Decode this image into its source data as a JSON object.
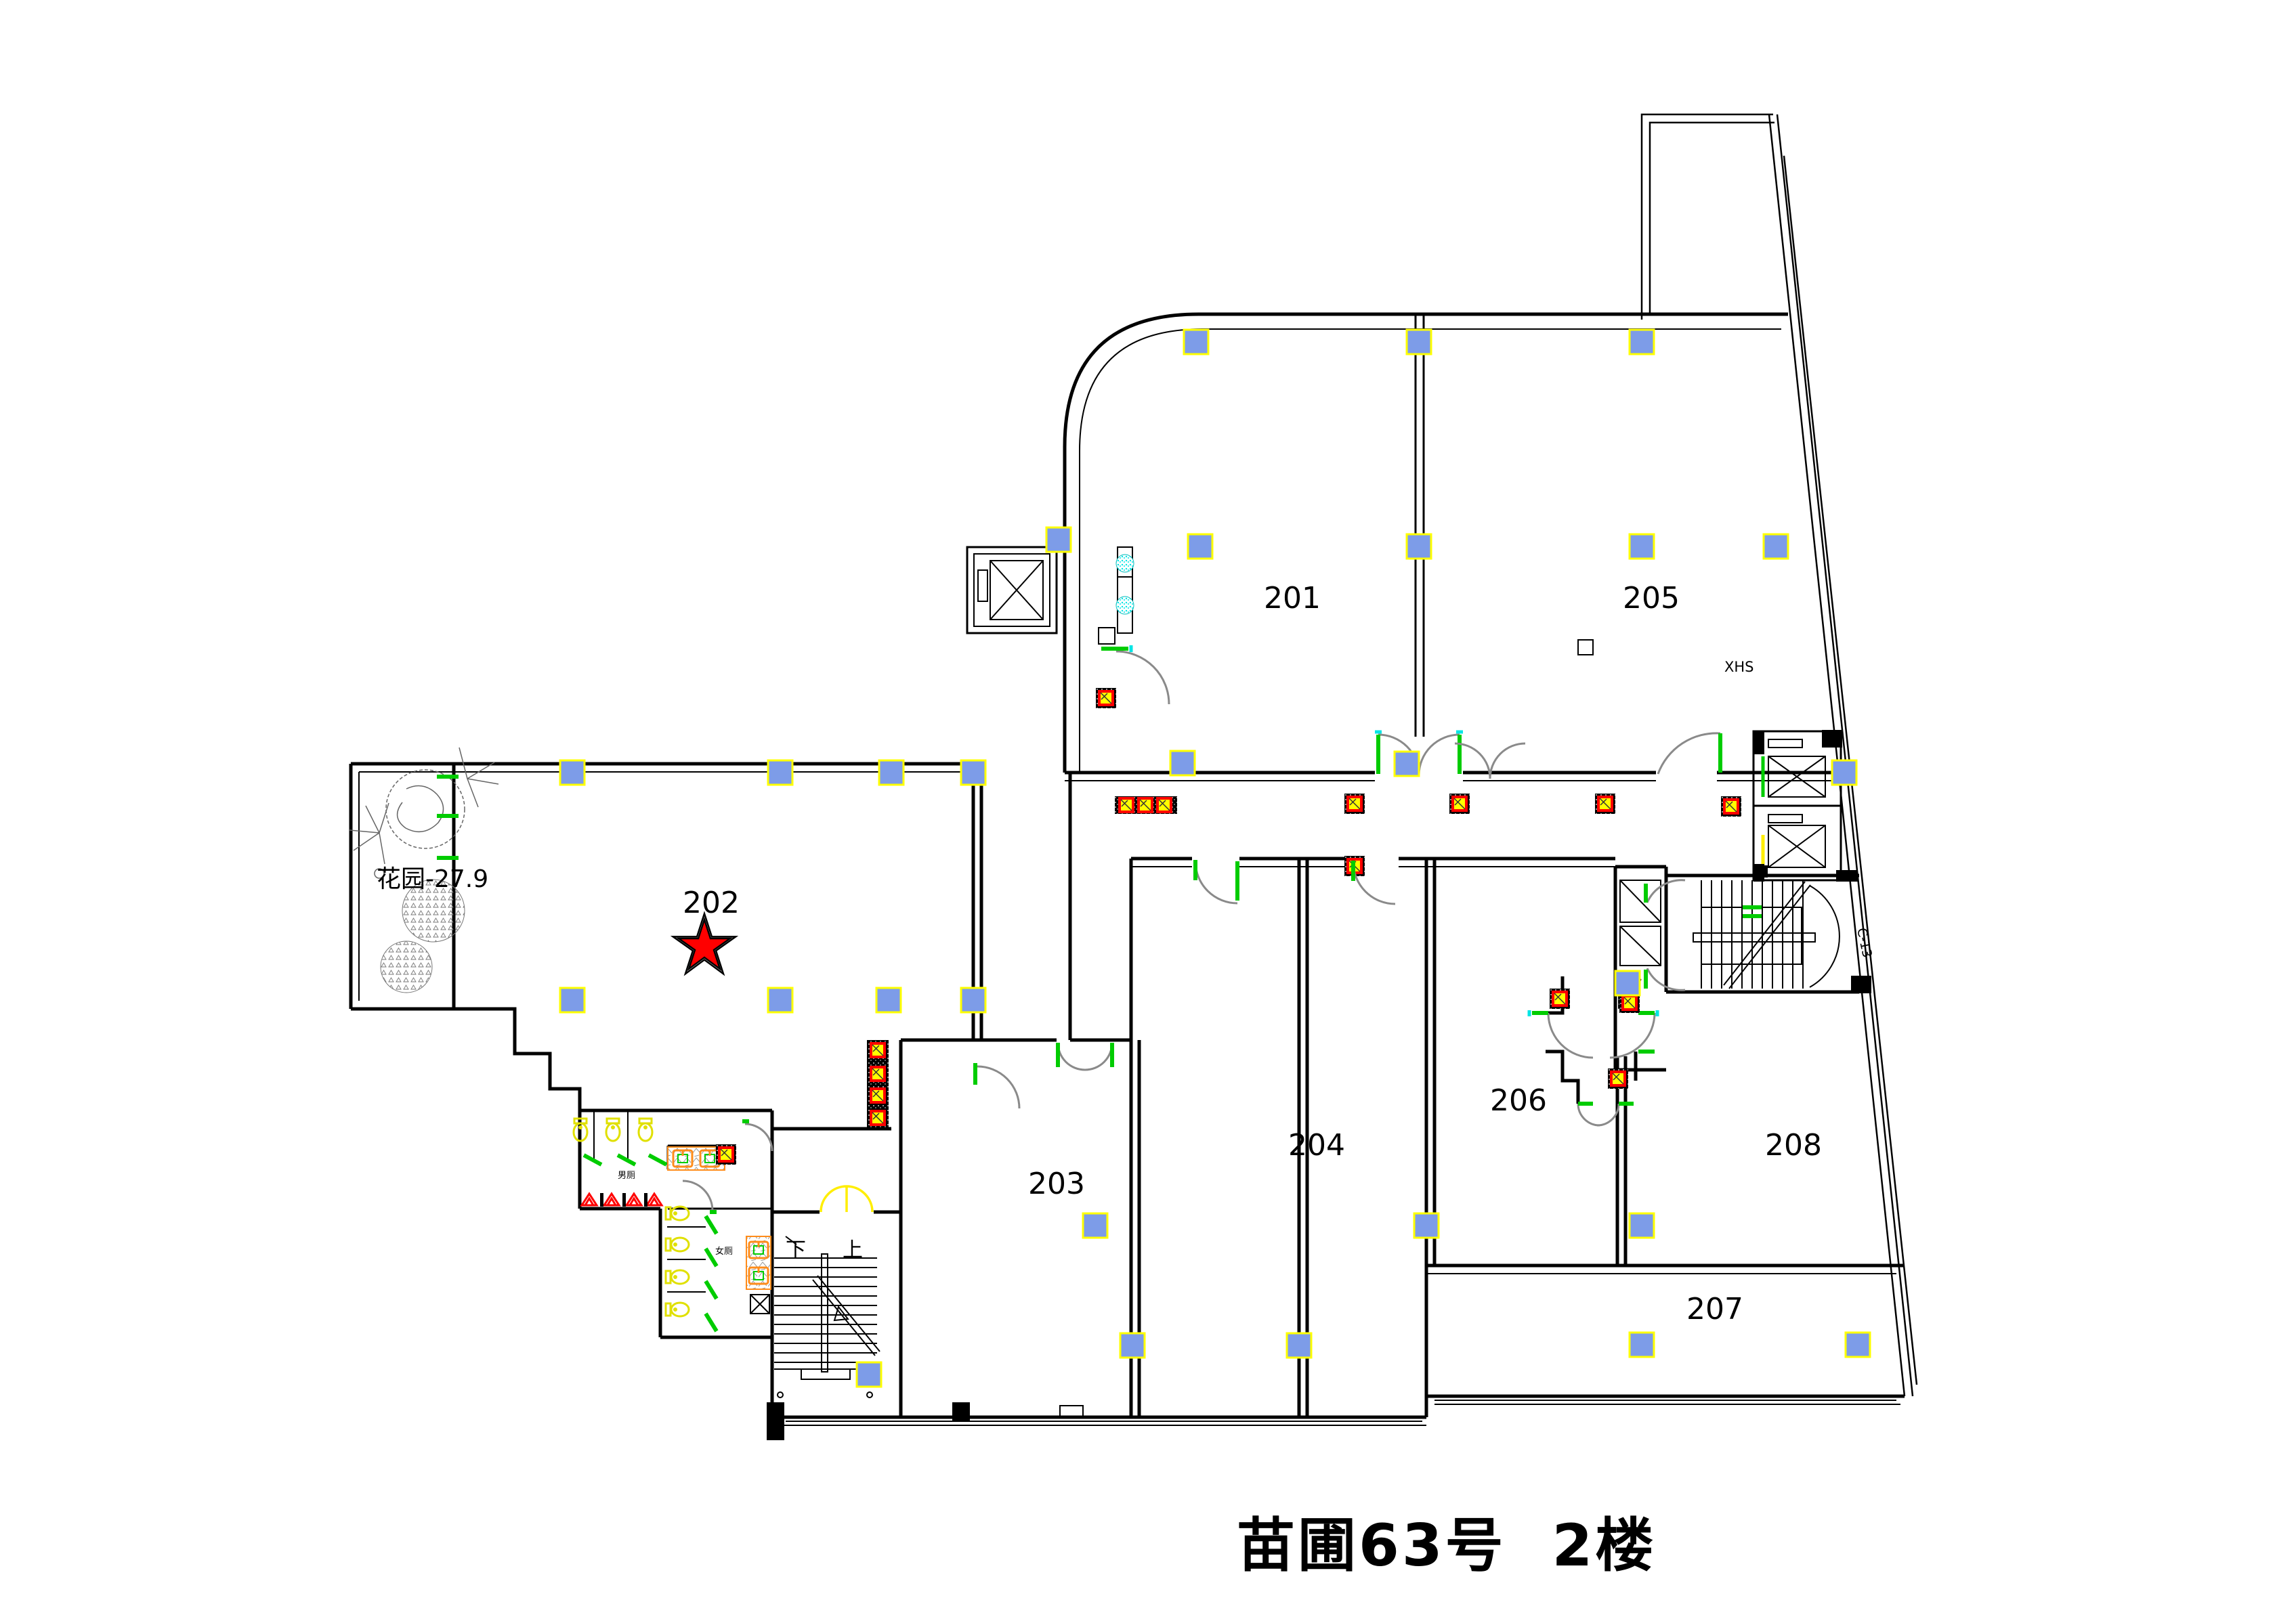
{
  "title": "苗圃63号  2楼",
  "rooms": [
    {
      "number": "201"
    },
    {
      "number": "202"
    },
    {
      "number": "203"
    },
    {
      "number": "204"
    },
    {
      "number": "205"
    },
    {
      "number": "206"
    },
    {
      "number": "207"
    },
    {
      "number": "208"
    }
  ],
  "annotations": {
    "garden": "花园-27.9",
    "xhs": "XHS",
    "power_room": "配电",
    "stair_down": "下",
    "stair_up": "上",
    "curve_mark": "C-13",
    "mens_room": "男厕",
    "womens_room": "女厕"
  },
  "colors": {
    "background": "#ffffff",
    "wall": "#000000",
    "grid_marker_fill": "#7d9ce8",
    "grid_marker_outline": "#ffff00",
    "door_frame_green": "#00cc00",
    "door_swing_gray": "#8a8a8a",
    "stair_door_yellow": "#ffee00",
    "fixture_red": "#ff0000",
    "fixture_yellow": "#ffff00",
    "sanitary_yellow": "#e0e000",
    "urinal_red": "#ff0000",
    "sink_orange": "#ff8c1a",
    "plant_cyan": "#00e5e5",
    "hinge_cyan": "#00e5e5",
    "star_red": "#ff0000"
  }
}
